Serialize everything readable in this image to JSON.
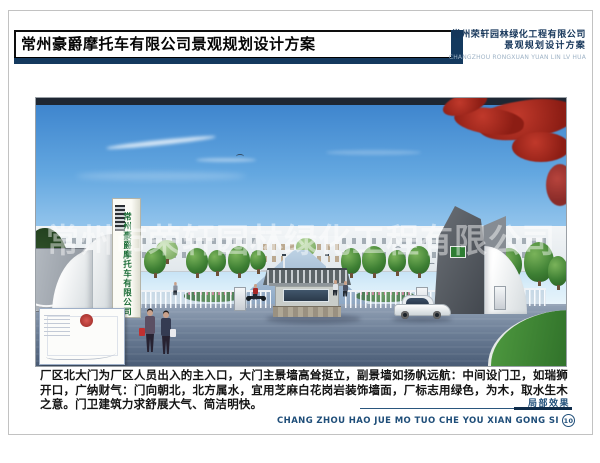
{
  "header": {
    "title": "常州豪爵摩托车有限公司景观规划设计方案",
    "firm_name": "常州荣轩园林绿化工程有限公司",
    "firm_subtitle": "景观规划设计方案",
    "firm_pinyin": "CHANGZHOU RONGXUAN YUAN LIN LV HUA"
  },
  "rendering": {
    "tower_text": "常州豪爵摩托车有限公司",
    "watermark": "常州市荣轩园林绿化工程有限公司"
  },
  "footer": {
    "description": "厂区北大门为厂区人员出入的主入口，大门主景墙高耸挺立，副景墙如扬帆远航：中间设门卫，如瑞狮开口，广纳财气：门向朝北，北方属水，宜用芝麻白花岗岩装饰墙面，厂标志用绿色，为木，取水生木之意。门卫建筑力求舒展大气、简洁明快。",
    "caption": "局部效果",
    "pinyin": "CHANG ZHOU HAO JUE MO TUO CHE YOU XIAN GONG SI",
    "page_number": "10"
  },
  "colors": {
    "navy": "#14395e",
    "caption_blue": "#1f4e79",
    "tower_green": "#1d6e38",
    "maple_red": "#8c1d14",
    "lawn_green": "#3e8c38",
    "sky_blue": "#3b82cc"
  }
}
